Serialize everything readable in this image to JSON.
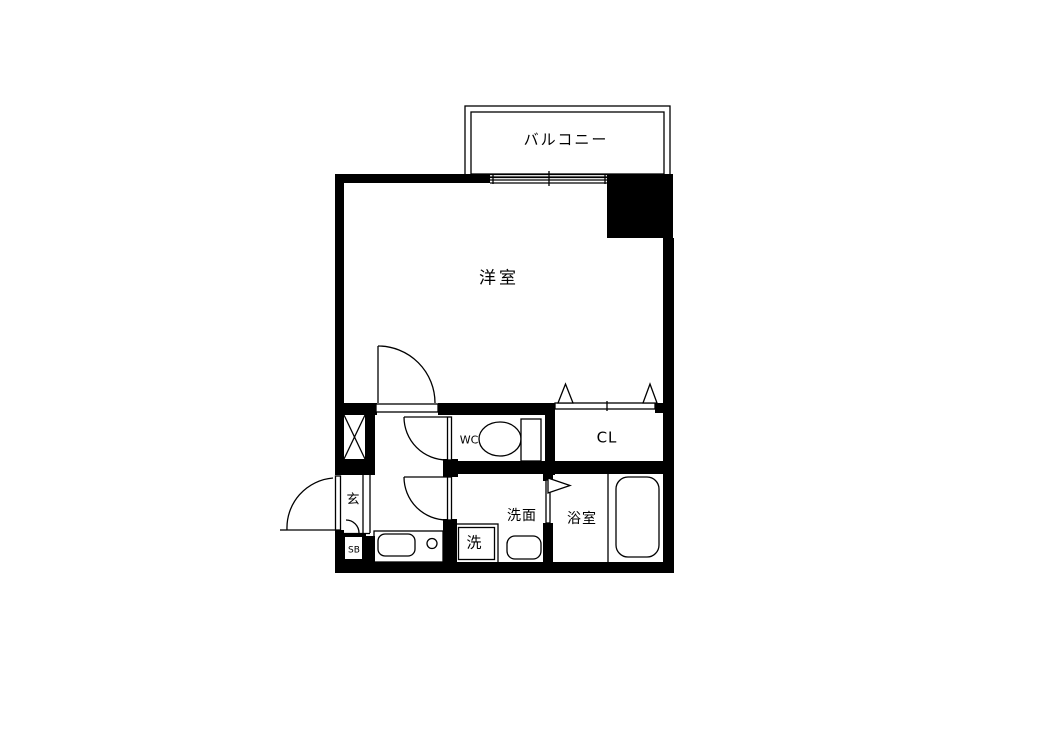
{
  "colors": {
    "ink": "#000000",
    "paper": "#ffffff"
  },
  "rooms": {
    "balcony": "バルコニー",
    "western_room": "洋室",
    "toilet": "WC",
    "closet": "CL",
    "entrance": "玄",
    "shoe_box": "SB",
    "laundry": "洗",
    "washroom": "洗面",
    "bathroom": "浴室"
  }
}
